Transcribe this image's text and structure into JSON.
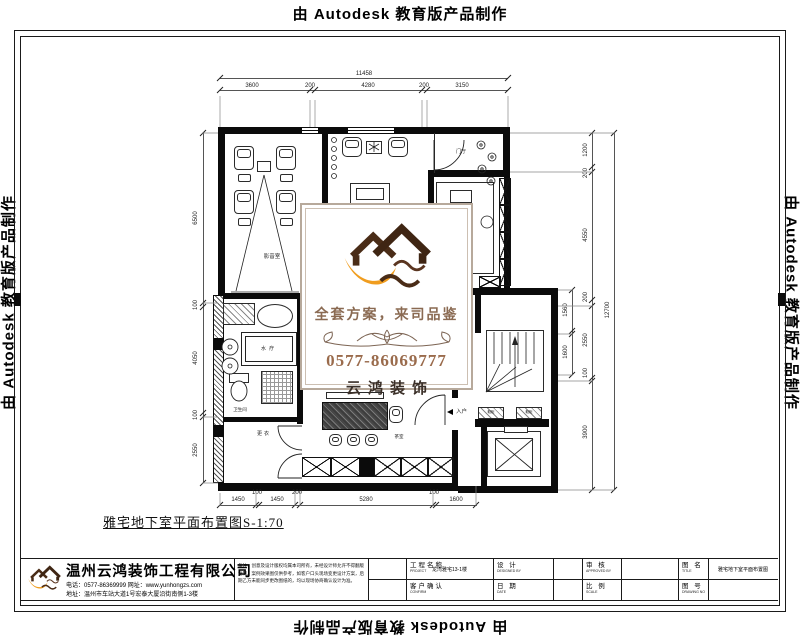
{
  "banner": {
    "text": "由 Autodesk 教育版产品制作"
  },
  "watermark": {
    "slogan": "全套方案，来司品鉴",
    "phone": "0577-86069777",
    "brand": "云鸿装饰"
  },
  "caption": "雅宅地下室平面布置图S-1:70",
  "plan": {
    "labels": {
      "theater": "影音室",
      "foyer": "门厅",
      "spa": "水疗",
      "bath": "卫生间",
      "dressing": "更衣",
      "tea": "茶室",
      "entry": "入户",
      "shoe_left": "鞋柜",
      "shoe_right": "鞋柜"
    },
    "dims": {
      "top_total": "11458",
      "top": [
        "3600",
        "200",
        "4280",
        "200",
        "3150"
      ],
      "left": [
        "6500",
        "100",
        "4050",
        "100",
        "2550"
      ],
      "right_total": "12700",
      "right": [
        "1200",
        "200",
        "4550",
        "200",
        "2550",
        "100",
        "3900"
      ],
      "right_inner": [
        "1560",
        "1600"
      ],
      "bottom": [
        "1450",
        "100",
        "1450",
        "200",
        "5280",
        "100",
        "1600"
      ]
    }
  },
  "titleblock": {
    "company": {
      "name": "温州云鸿装饰工程有限公司",
      "phone": "电话：0577-86369999  网址：www.yunhongzs.com",
      "address": "地址：温州市车站大道1号宏泰大厦沿街南侧1-3楼"
    },
    "notes": "备注：创意及设计版权均属本司所有，未经设计师允许不得翻版复制。案例效果图仅供参考，如客户口头现场变更设计方案，后期乙方未能同步更改图纸的，均以现场协商确认设计为准。",
    "fields": [
      {
        "label": "工程名称",
        "sub": "PROJECT",
        "value": "龙湾雅宅13-1楼"
      },
      {
        "label": "客户确认",
        "sub": "CONFIRM",
        "value": ""
      },
      {
        "label": "设 计",
        "sub": "DESIGNED BY",
        "value": ""
      },
      {
        "label": "日 期",
        "sub": "DATE",
        "value": ""
      },
      {
        "label": "审 核",
        "sub": "APPROVED BY",
        "value": ""
      },
      {
        "label": "比 例",
        "sub": "SCALE",
        "value": ""
      },
      {
        "label": "图 名",
        "sub": "TITLE",
        "value": "雅宅地下室平面布置图"
      },
      {
        "label": "图 号",
        "sub": "DRAWING NO",
        "value": ""
      }
    ]
  },
  "colors": {
    "accent_orange": "#f09d1f",
    "logo_brown": "#4a2c17",
    "watermark_text": "#8a6a52"
  }
}
